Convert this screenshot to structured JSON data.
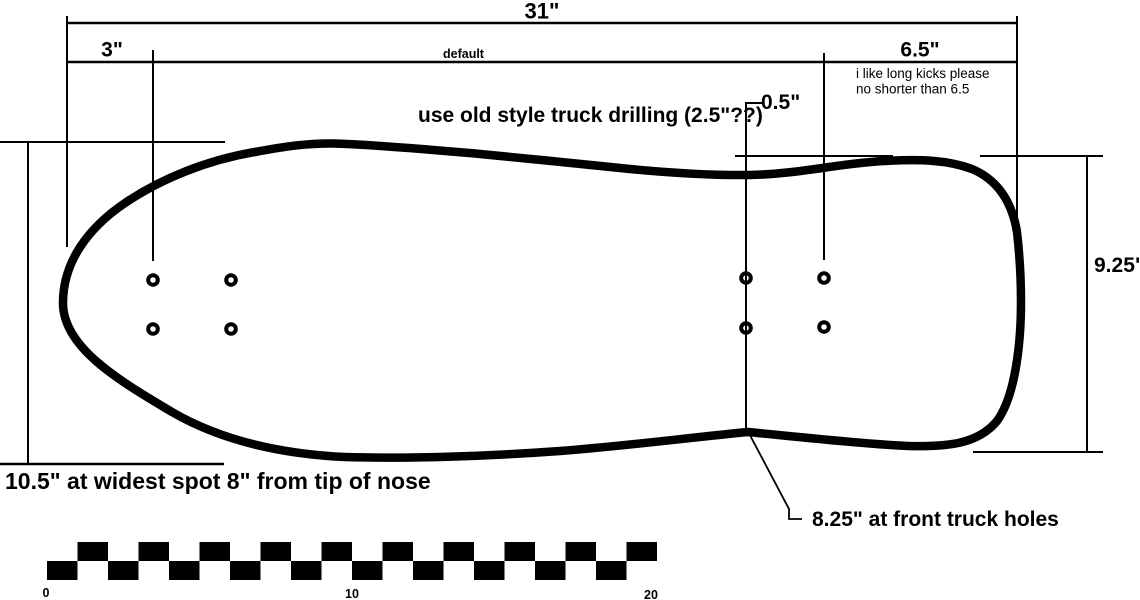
{
  "colors": {
    "ink": "#000000",
    "background": "#ffffff"
  },
  "labels": {
    "total_length": "31\"",
    "nose": "3\"",
    "default_note": "default",
    "tail": "6.5\"",
    "kick_note_line1": "i like long kicks please",
    "kick_note_line2": "no shorter than 6.5",
    "dip": "0.5\"",
    "drilling_note": "use old style truck drilling (2.5\"??)",
    "width": "9.25\"",
    "widest_note": "10.5\" at widest spot 8\" from tip of nose",
    "front_truck_note": "8.25\" at front truck holes"
  },
  "scale_bar": {
    "units": 20,
    "square_width": 30.5,
    "square_height": 19,
    "origin_x": 47,
    "origin_y": 542,
    "square_color": "#000000",
    "tick_labels": [
      "0",
      "10",
      "20"
    ]
  }
}
